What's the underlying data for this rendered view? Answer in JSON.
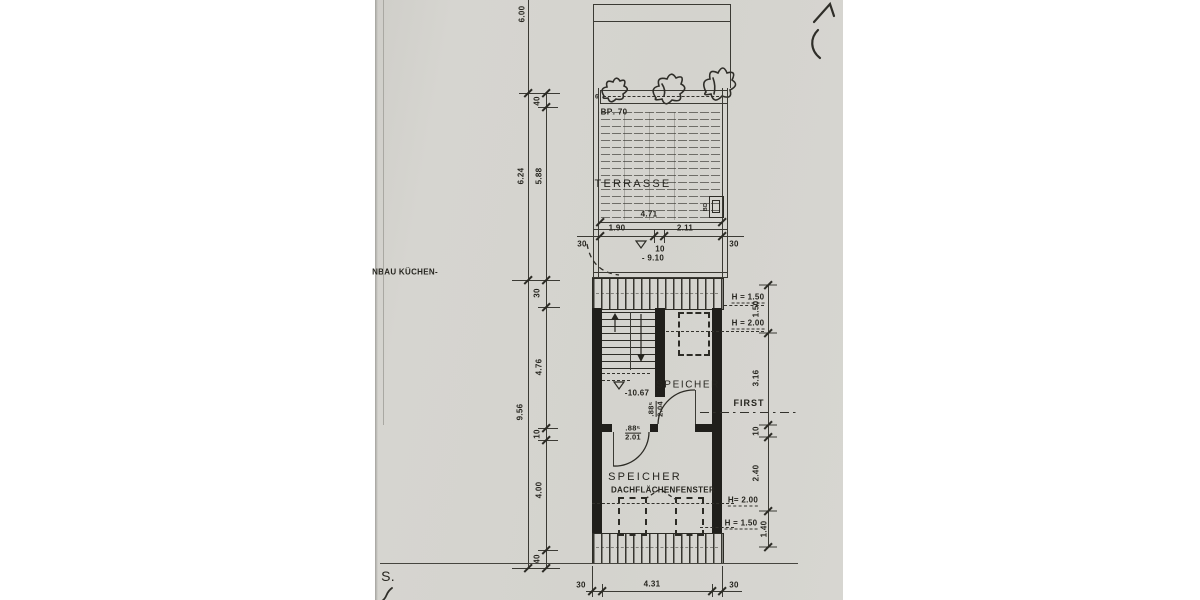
{
  "colors": {
    "paper": "#d4d3ce",
    "ink": "#33322c",
    "wall": "#201f1b"
  },
  "labels": {
    "side_note": "NBAU KÜCHEN-",
    "handwritten_s": "S.",
    "dim_600": "6.00",
    "dim_40_top": "40",
    "dim_624": "6.24",
    "dim_588": "5.88",
    "dim_956": "9.56",
    "dim_30_left": "30",
    "dim_476": "4.76",
    "dim_10_left": "10",
    "dim_400": "4.00",
    "dim_40_bottom": "40",
    "planter_mark": "6",
    "planter_label": "BR. 70",
    "terrace": "TERRASSE",
    "drain": "BD",
    "dim_471": "4.71",
    "dim_190": "1.90",
    "dim_10_mid": "10",
    "dim_211": "2.11",
    "dim_30_terr_left": "30",
    "dim_30_terr_right": "30",
    "level_terrace": "- 9.10",
    "h150_top": "H = 1.50",
    "h200_top": "H = 2.00",
    "dim_150_right": "1.50",
    "dim_316": "3.16",
    "first": "FIRST",
    "dim_10_right": "10",
    "dim_240": "2.40",
    "h200_bottom": "H= 2.00",
    "dim_140": "1.40",
    "h150_bottom": "H = 1.50",
    "speicher_upper": "SPEICHER",
    "level_attic": "-10.67",
    "door_upper_w": ".88⁵",
    "door_upper_h": "2.04",
    "door_lower_w": ".88⁵",
    "door_lower_h": "2.01",
    "speicher_lower": "SPEICHER",
    "roof_window": "DACHFLÄCHENFENSTER",
    "dim_30_bot_left": "30",
    "dim_431": "4.31",
    "dim_30_bot_right": "30"
  }
}
